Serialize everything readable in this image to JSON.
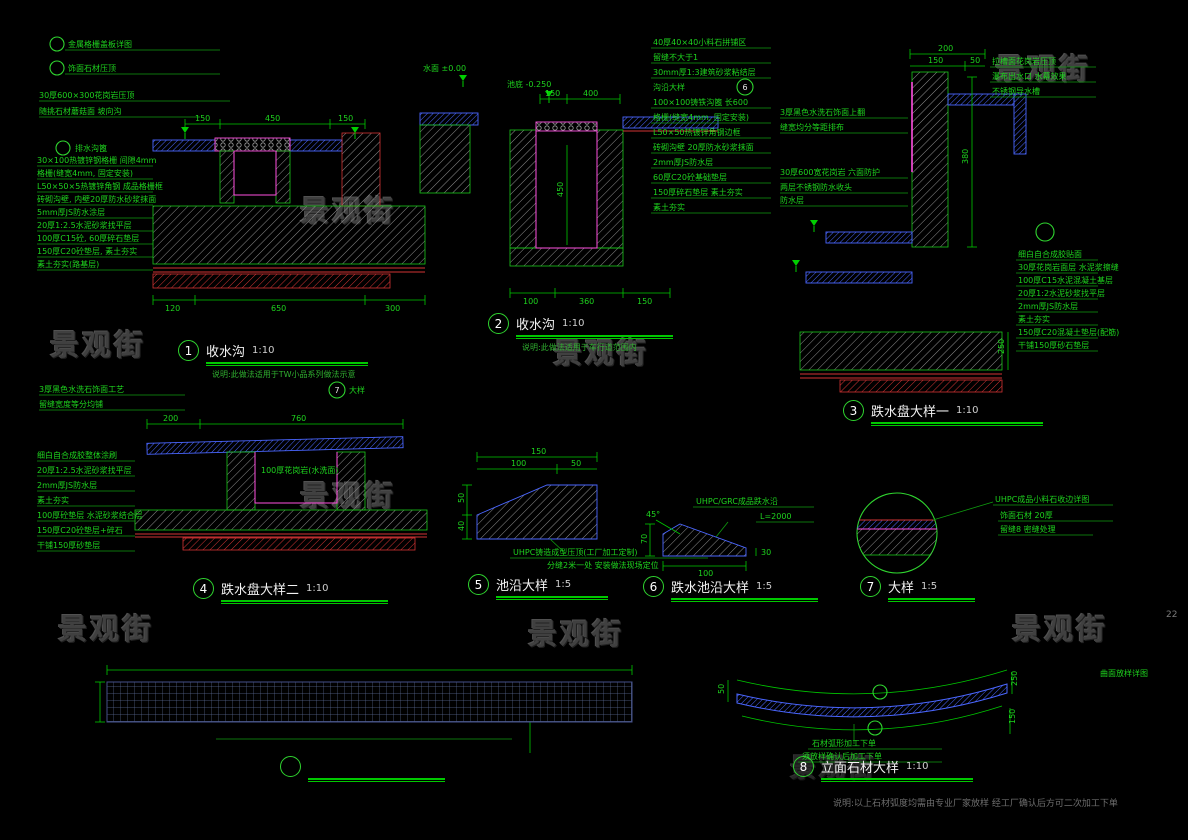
{
  "watermark": {
    "text": "景观街"
  },
  "page_number": "22",
  "bottom_note": "说明:以上石材弧度均需由专业厂家放样 经工厂确认后方可二次加工下单",
  "colors": {
    "dim_green": "#00c800",
    "stone_blue": "#4a66ff",
    "waterproof_magenta": "#ff4fe1",
    "subbase_red": "#d23434",
    "logo_orange": "#c57f4a",
    "background": "#000000"
  },
  "details": {
    "d1": {
      "num": "1",
      "title": "收水沟",
      "scale": "1:10",
      "note": "说明:此做法适用于TW小品系列做法示意",
      "top_labels": [
        "金属格栅盖板详图",
        "饰面石材压顶",
        "30厚600×300花岗岩压顶",
        "随挑石材蘑菇面 坡向沟"
      ],
      "callout_label": "排水沟篦",
      "layer_labels": [
        "30×100热镀锌钢格栅 间隙4mm",
        "格栅(缝宽4mm, 固定安装)",
        "L50×50×5热镀锌角钢 成品格栅框",
        "砖砌沟壁, 内壁20厚防水砂浆抹面",
        "5mm厚JS防水涂层",
        "20厚1:2.5水泥砂浆找平层",
        "100厚C15砼, 60厚碎石垫层",
        "150厚C20砼垫层, 素土夯实",
        "素土夯实(路基层)"
      ],
      "dims_top": [
        "150",
        "450",
        "150"
      ],
      "dims_bottom": [
        "120",
        "650",
        "300"
      ]
    },
    "d2": {
      "num": "2",
      "title": "收水沟",
      "scale": "1:10",
      "note": "说明:此做法适用于车行道范围内",
      "levels": [
        "水面 ±0.00",
        "池底 -0.250"
      ],
      "right_labels": [
        "40厚40×40小料石拼铺区",
        "留缝不大于1",
        "30mm厚1:3建筑砂浆粘结层",
        "沟沿大样",
        "100×100铸铁沟篦 长600",
        "格栅(缝宽4mm, 固定安装)",
        "L50×50热镀锌角钢边框",
        "砖砌沟壁 20厚防水砂浆抹面",
        "2mm厚JS防水层",
        "60厚C20砼基础垫层",
        "150厚碎石垫层 素土夯实",
        "素土夯实"
      ],
      "callout_num": "6",
      "dims_top": [
        "150",
        "400"
      ],
      "dim_inner": "450",
      "dims_bottom": [
        "100",
        "360",
        "150"
      ]
    },
    "d3": {
      "num": "3",
      "title": "跌水盘大样一",
      "scale": "1:10",
      "left_labels": [
        "3厚黑色水洗石饰面上翻",
        "缝宽均分等距排布",
        "30厚600宽花岗岩 六面防护",
        "两层不锈钢防水收头",
        "防水层"
      ],
      "right_top_labels": [
        "拉槽面花岗岩压顶",
        "瀑布出水口 水幕效果",
        "不锈钢导水槽"
      ],
      "right_labels": [
        "细白自合成胶贴面",
        "30厚花岗岩面层 水泥浆擦缝",
        "100厚C15水泥混凝土基层",
        "20厚1:2水泥砂浆找平层",
        "2mm厚JS防水层",
        "素土夯实",
        "150厚C20混凝土垫层(配筋)",
        "干铺150厚砂石垫层"
      ],
      "dims": {
        "top": "200",
        "sub_left": "150",
        "sub_right": "50",
        "height": "380",
        "right": "250"
      }
    },
    "d4": {
      "num": "4",
      "title": "跌水盘大样二",
      "scale": "1:10",
      "top_labels": [
        "3厚黑色水洗石饰面工艺",
        "留缝宽度等分均铺"
      ],
      "callout": {
        "num": "7",
        "label": "大样"
      },
      "inner_label": "100厚花岗岩(水洗面)",
      "left_labels": [
        "细白自合成胶整体涂刷",
        "20厚1:2.5水泥砂浆找平层",
        "2mm厚JS防水层",
        "素土夯实",
        "100厚砼垫层 水泥砂浆结合层",
        "150厚C20砼垫层+碎石",
        "干铺150厚砂垫层"
      ],
      "dims_top": [
        "200",
        "760"
      ]
    },
    "d5": {
      "num": "5",
      "title": "池沿大样",
      "scale": "1:5",
      "dims": {
        "total": "150",
        "sub_left": "100",
        "sub_right": "50",
        "left_top": "50",
        "left_bottom": "40"
      },
      "notes": [
        "UHPC铸造成型压顶(工厂加工定制)",
        "分缝2米一处 安装做法现场定位"
      ]
    },
    "d6": {
      "num": "6",
      "title": "跌水池沿大样",
      "scale": "1:5",
      "labels": [
        "UHPC/GRC成品跌水沿",
        "L=2000"
      ],
      "dims": {
        "angle": "45°",
        "left": "70",
        "bottom": "100",
        "right": "30"
      }
    },
    "d7": {
      "num": "7",
      "title": "大样",
      "scale": "1:5",
      "labels": [
        "UHPC成品小料石收边详图",
        "饰面石材 20厚",
        "留缝8 密缝处理"
      ]
    },
    "logo": {
      "num": "7",
      "title": "LOGO大样",
      "scale": "1:5",
      "text": "万科·翡翠滨江  EMERALD RIVERSIDE",
      "notes": [
        "1.5mm不锈钢7字口, 7字边出墙不得大于10mm",
        "电镀金色 拉丝, 详立面"
      ],
      "dim_top": "3765",
      "dim_left": "370"
    },
    "d8": {
      "num": "8",
      "title": "立面石材大样",
      "scale": "1:10",
      "notes": [
        "石材弧形加工下单",
        "须放样确认后加工下单"
      ],
      "right_label": "曲面放样详图",
      "dims": {
        "right_top": "250",
        "right_bottom": "150",
        "left": "50"
      }
    }
  }
}
